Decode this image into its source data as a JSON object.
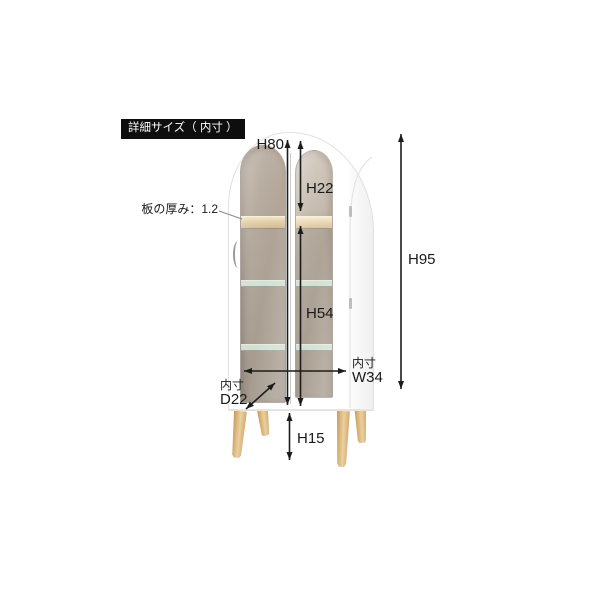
{
  "title_badge": {
    "text": "詳細サイズ（ 内寸 ）"
  },
  "dimensions": {
    "h80": {
      "label": "H80"
    },
    "h22": {
      "label": "H22"
    },
    "h54": {
      "label": "H54"
    },
    "h95": {
      "label": "H95"
    },
    "h15": {
      "label": "H15"
    },
    "w34": {
      "prefix": "内寸",
      "label": "W34"
    },
    "d22": {
      "prefix": "内寸",
      "label": "D22"
    },
    "board_thickness": {
      "label": "板の厚み：1.2"
    }
  },
  "colors": {
    "background": "#ffffff",
    "badge_bg": "#0e0e0e",
    "badge_text": "#ffffff",
    "annotation_line": "#1c1c1c",
    "cabinet_white": "#ffffff",
    "cabinet_edge": "#e1e1e1",
    "interior_taupe": "#aba093",
    "wood_shelf": "#e3d1ac",
    "glass_shelf": "#dcebe1",
    "leg_wood": "#dcb87e"
  }
}
